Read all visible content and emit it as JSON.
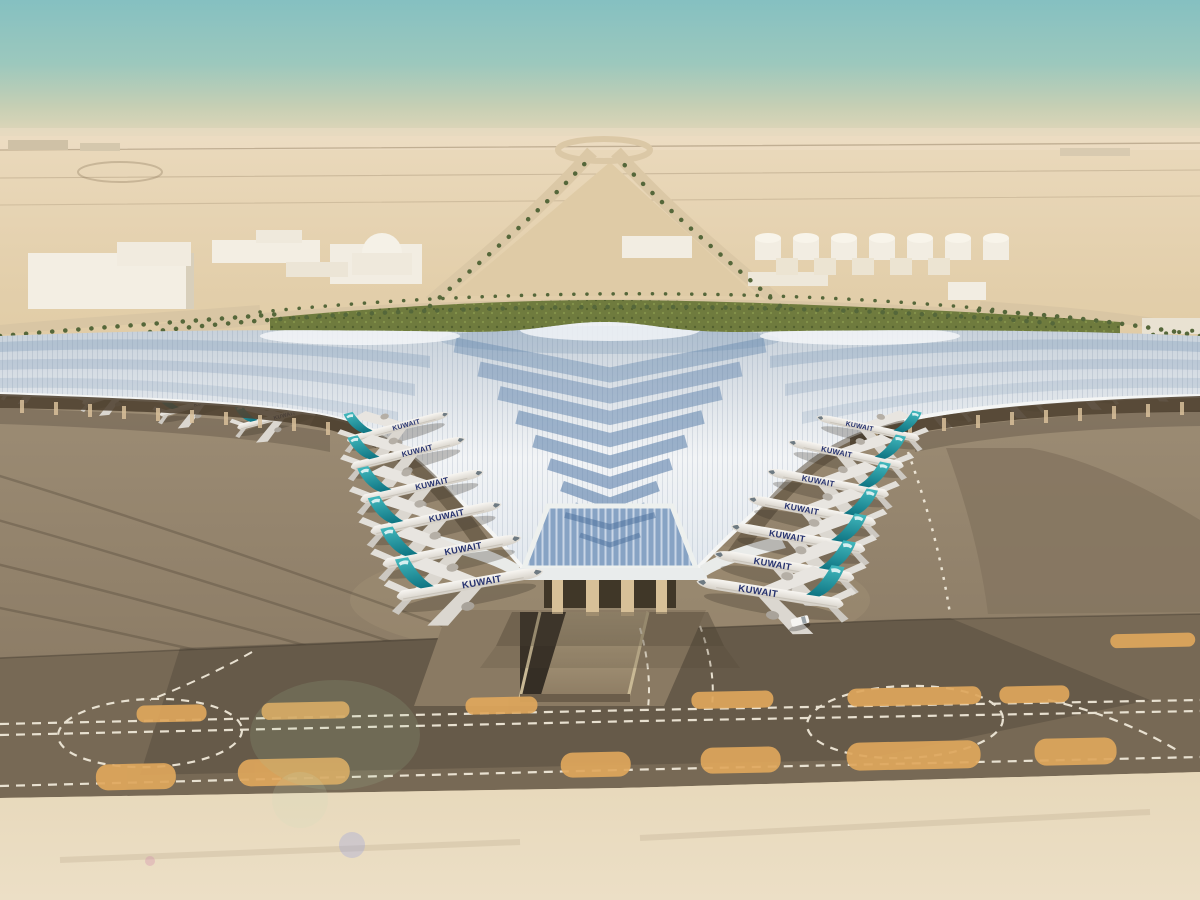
{
  "scene": {
    "subject": "Aerial rendering of a desert airport terminal with trefoil swooping roof",
    "airline": "KUWAIT",
    "aircraft_count": 21,
    "palette": {
      "sky_top": "#85c0c1",
      "sky_horizon": "#e7d8ba",
      "desert": "#e3cfab",
      "roof_silver": "#eef1f4",
      "roof_panel_blue": "#5d81ab",
      "glass_blue": "#87a3c4",
      "tail_teal": "#1f98a2",
      "fuselage_white": "#f4f2ed",
      "apron_concrete": "#96866e",
      "taxiway_dark": "#776955",
      "marking_white": "#efe8d8",
      "pad_orange": "#dfa75c",
      "palm_green": "#55673a",
      "landscape_green": "#6f7b3e",
      "column_tan": "#d7c098",
      "title_navy": "#25316e"
    },
    "planes": [
      {
        "x": 35,
        "y": 383,
        "rot": -16,
        "s": 0.55,
        "dir": "R",
        "layer": "under"
      },
      {
        "x": 118,
        "y": 393,
        "rot": -16,
        "s": 0.6,
        "dir": "R",
        "layer": "under"
      },
      {
        "x": 198,
        "y": 404,
        "rot": -16,
        "s": 0.64,
        "dir": "R",
        "layer": "under"
      },
      {
        "x": 278,
        "y": 417,
        "rot": -15,
        "s": 0.68,
        "dir": "R",
        "layer": "under"
      },
      {
        "x": 930,
        "y": 404,
        "rot": 12,
        "s": 0.66,
        "dir": "L",
        "layer": "under"
      },
      {
        "x": 1006,
        "y": 396,
        "rot": 12,
        "s": 0.62,
        "dir": "L",
        "layer": "under"
      },
      {
        "x": 1082,
        "y": 389,
        "rot": 12,
        "s": 0.58,
        "dir": "L",
        "layer": "under"
      },
      {
        "x": 1150,
        "y": 382,
        "rot": 12,
        "s": 0.55,
        "dir": "L",
        "layer": "under"
      },
      {
        "x": 398,
        "y": 427,
        "rot": -15,
        "s": 0.85,
        "dir": "R",
        "layer": "front"
      },
      {
        "x": 408,
        "y": 453,
        "rot": -14,
        "s": 0.95,
        "dir": "R",
        "layer": "front"
      },
      {
        "x": 422,
        "y": 486,
        "rot": -13,
        "s": 1.02,
        "dir": "R",
        "layer": "front"
      },
      {
        "x": 436,
        "y": 518,
        "rot": -12,
        "s": 1.08,
        "dir": "R",
        "layer": "front"
      },
      {
        "x": 452,
        "y": 551,
        "rot": -11,
        "s": 1.14,
        "dir": "R",
        "layer": "front"
      },
      {
        "x": 470,
        "y": 584,
        "rot": -10,
        "s": 1.2,
        "dir": "R",
        "layer": "front"
      },
      {
        "x": 868,
        "y": 428,
        "rot": 12,
        "s": 0.85,
        "dir": "L",
        "layer": "front"
      },
      {
        "x": 846,
        "y": 454,
        "rot": 12,
        "s": 0.95,
        "dir": "L",
        "layer": "front"
      },
      {
        "x": 828,
        "y": 483,
        "rot": 11,
        "s": 1.0,
        "dir": "L",
        "layer": "front"
      },
      {
        "x": 812,
        "y": 511,
        "rot": 11,
        "s": 1.05,
        "dir": "L",
        "layer": "front"
      },
      {
        "x": 798,
        "y": 538,
        "rot": 10,
        "s": 1.1,
        "dir": "L",
        "layer": "front"
      },
      {
        "x": 784,
        "y": 566,
        "rot": 10,
        "s": 1.15,
        "dir": "L",
        "layer": "front"
      },
      {
        "x": 770,
        "y": 593,
        "rot": 9,
        "s": 1.2,
        "dir": "L",
        "layer": "front"
      }
    ]
  }
}
